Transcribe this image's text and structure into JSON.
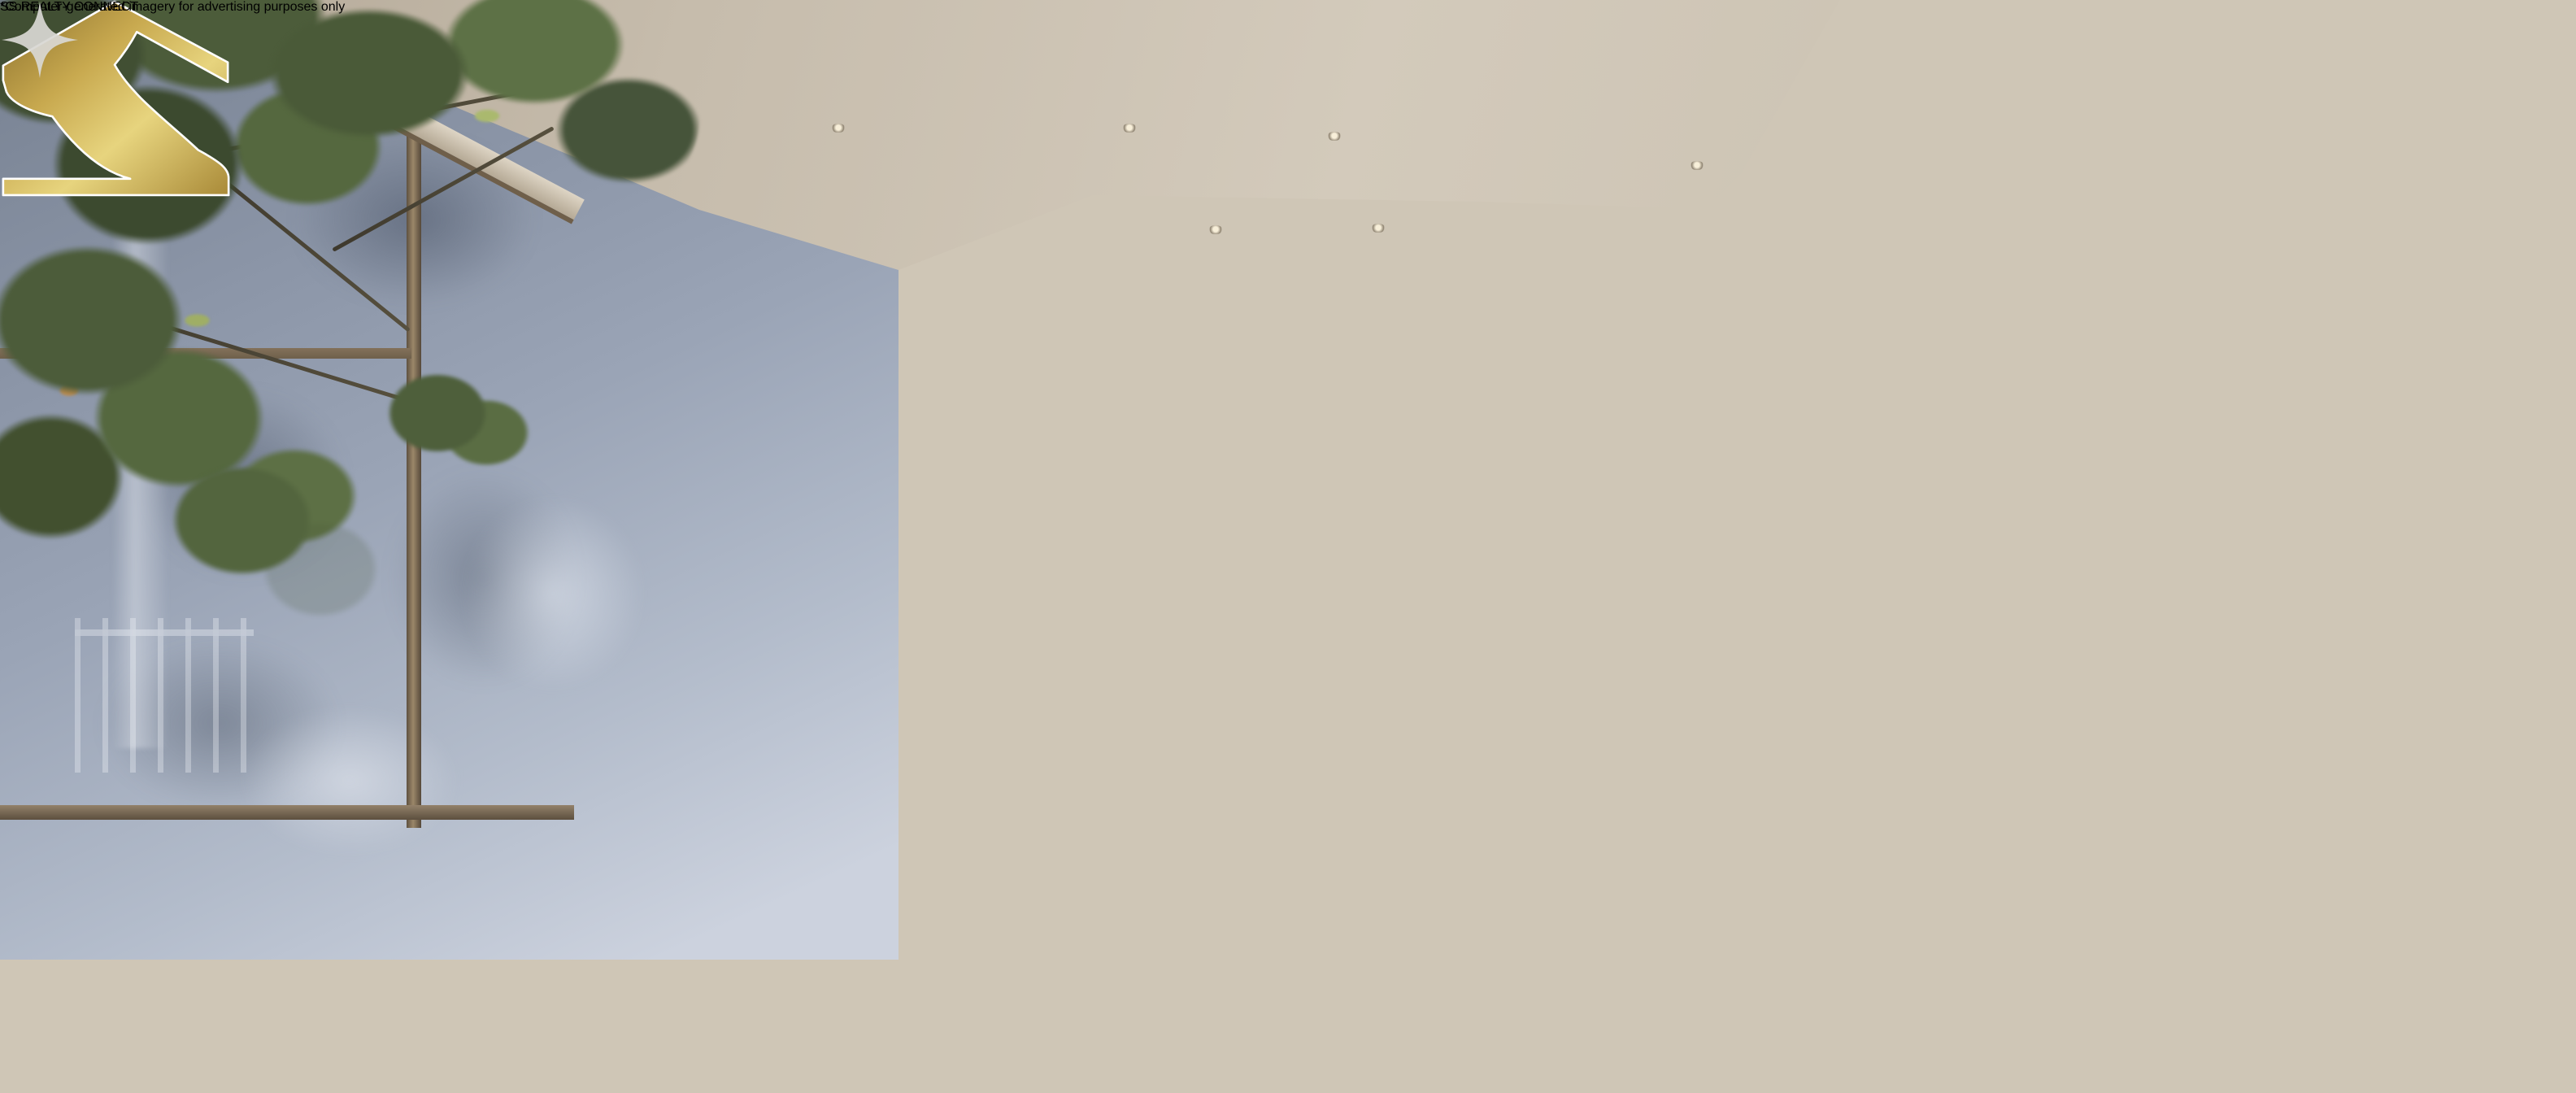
{
  "scene_alt": "Computer-generated rendering of a family of four playing a board game on a bed in a modern bedroom, with a tree courtyard window, window bench with laptop and coffee, glass-walled bathroom with shower and lit mirror, wood feature wall, black side bench with books, headphones and sculptural lamp",
  "watermark": {
    "brand_name": "SS.REALTY CONNECT",
    "mark": "gold-house-s-monogram",
    "gold_color": "#c9a44b",
    "outline_color": "#f6f1e2"
  },
  "disclaimer": {
    "text": "*Computer-generated imagery for advertising purposes only"
  },
  "icons": {
    "sparkle": "four-point-sparkle-icon",
    "apple": "apple-logo-icon"
  },
  "palette": {
    "ceiling": "#cdc4b6",
    "courtyard_wall": "#97a1b1",
    "foliage_green": "#5d7045",
    "oak_bench": "#c2a77e",
    "wood_wall": "#8d7457",
    "bedding_white": "#eae5da",
    "throw_tan": "#b98f62",
    "rug": "#b7a98e",
    "lamp_black": "#121009",
    "denim_blue": "#5572a0",
    "chips_red": "#c8502e"
  }
}
